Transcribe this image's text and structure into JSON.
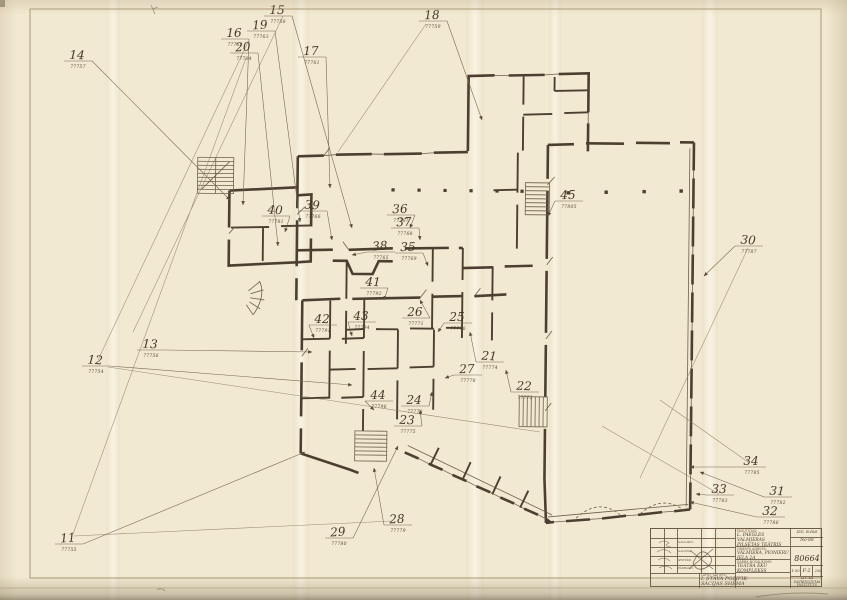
{
  "sheet": {
    "paper_color": "#f2e9d2",
    "ink_color": "#4c3f31",
    "leader_color": "#7a6951"
  },
  "plan": {
    "annotations": [
      {
        "n": "11",
        "code": "77755",
        "x": 68,
        "y": 540,
        "tx": 305,
        "ty": 452
      },
      {
        "n": "12",
        "code": "77754",
        "x": 95,
        "y": 362,
        "tx": 352,
        "ty": 385
      },
      {
        "n": "13",
        "code": "77756",
        "x": 150,
        "y": 346,
        "tx": 312,
        "ty": 352
      },
      {
        "n": "14",
        "code": "77757",
        "x": 77,
        "y": 57,
        "tx": 230,
        "ty": 200
      },
      {
        "n": "15",
        "code": "77758",
        "x": 277,
        "y": 12,
        "tx": 352,
        "ty": 228
      },
      {
        "n": "16",
        "code": "77762",
        "x": 234,
        "y": 35,
        "tx": 243,
        "ty": 205
      },
      {
        "n": "17",
        "code": "77761",
        "x": 311,
        "y": 53,
        "tx": 330,
        "ty": 188
      },
      {
        "n": "18",
        "code": "77759",
        "x": 432,
        "y": 17,
        "tx": 482,
        "ty": 120
      },
      {
        "n": "19",
        "code": "77763",
        "x": 260,
        "y": 27,
        "tx": 300,
        "ty": 222
      },
      {
        "n": "20",
        "code": "77764",
        "x": 243,
        "y": 49,
        "tx": 278,
        "ty": 246
      },
      {
        "n": "21",
        "code": "77774",
        "x": 489,
        "y": 358,
        "tx": 470,
        "ty": 332
      },
      {
        "n": "22",
        "code": "77772",
        "x": 524,
        "y": 388,
        "tx": 506,
        "ty": 370
      },
      {
        "n": "23",
        "code": "77775",
        "x": 407,
        "y": 422,
        "tx": 420,
        "ty": 410
      },
      {
        "n": "24",
        "code": "77773",
        "x": 414,
        "y": 402,
        "tx": 432,
        "ty": 392
      },
      {
        "n": "25",
        "code": "77776",
        "x": 457,
        "y": 319,
        "tx": 438,
        "ty": 332
      },
      {
        "n": "26",
        "code": "77771",
        "x": 415,
        "y": 314,
        "tx": 420,
        "ty": 300
      },
      {
        "n": "27",
        "code": "77778",
        "x": 467,
        "y": 371,
        "tx": 445,
        "ty": 378
      },
      {
        "n": "28",
        "code": "77779",
        "x": 397,
        "y": 521,
        "tx": 374,
        "ty": 468
      },
      {
        "n": "29",
        "code": "77780",
        "x": 338,
        "y": 534,
        "tx": 398,
        "ty": 446
      },
      {
        "n": "30",
        "code": "77787",
        "x": 748,
        "y": 242,
        "tx": 704,
        "ty": 276
      },
      {
        "n": "31",
        "code": "77782",
        "x": 777,
        "y": 493,
        "tx": 700,
        "ty": 472
      },
      {
        "n": "32",
        "code": "77786",
        "x": 770,
        "y": 513,
        "tx": 690,
        "ty": 502
      },
      {
        "n": "33",
        "code": "77783",
        "x": 719,
        "y": 491,
        "tx": 696,
        "ty": 494
      },
      {
        "n": "34",
        "code": "77785",
        "x": 751,
        "y": 463,
        "tx": 690,
        "ty": 467
      },
      {
        "n": "35",
        "code": "77769",
        "x": 408,
        "y": 249,
        "tx": 428,
        "ty": 266
      },
      {
        "n": "36",
        "code": "77767",
        "x": 400,
        "y": 211,
        "tx": 410,
        "ty": 228
      },
      {
        "n": "37",
        "code": "77768",
        "x": 404,
        "y": 224,
        "tx": 420,
        "ty": 240
      },
      {
        "n": "38",
        "code": "77765",
        "x": 380,
        "y": 248,
        "tx": 352,
        "ty": 255
      },
      {
        "n": "39",
        "code": "77766",
        "x": 312,
        "y": 207,
        "tx": 332,
        "ty": 240
      },
      {
        "n": "40",
        "code": "77781",
        "x": 275,
        "y": 212,
        "tx": 285,
        "ty": 232
      },
      {
        "n": "41",
        "code": "77792",
        "x": 373,
        "y": 284,
        "tx": 384,
        "ty": 300
      },
      {
        "n": "42",
        "code": "77791",
        "x": 322,
        "y": 321,
        "tx": 314,
        "ty": 338
      },
      {
        "n": "43",
        "code": "77794",
        "x": 361,
        "y": 318,
        "tx": 352,
        "ty": 336
      },
      {
        "n": "44",
        "code": "77796",
        "x": 378,
        "y": 397,
        "tx": 374,
        "ty": 410
      },
      {
        "n": "45",
        "code": "77805",
        "x": 568,
        "y": 197,
        "tx": 548,
        "ty": 216
      }
    ]
  },
  "title_block": {
    "client_label": "PASŪTĪTĀJS:",
    "client_line1": "L. PAEGLES VALMIERAS",
    "client_line2": "PILSĒTAS TEĀTRIS",
    "address_label": "OBJEKTA ADRESE:",
    "address_line": "VALMIERA, PIONIERU IELA 2A",
    "work_label": "DARBA NOSAUKUMS:",
    "work_line": "TEĀTRA ĒKU KOMPLEKSS",
    "sheet_label": "LAPAS SATURS:",
    "sheet_line1": "I. STĀVA POZIFIK-",
    "sheet_line2": "SĀCIJAS SHĒMA",
    "drawn_code": "IZG. B.PAS",
    "order_no": "No-88",
    "project_no": "80664",
    "scale": "1:50",
    "stage": "F-2",
    "sheet_no": "230",
    "org_line1": "LVC KA",
    "org_line2": "SAVIENOJUMA",
    "org_line3": "INSTITŪTS",
    "stamp_rows": [
      "GALV.ARH.",
      "GALV.INŽ.",
      "IZSTRĀD.",
      "PĀRBAUD."
    ]
  }
}
